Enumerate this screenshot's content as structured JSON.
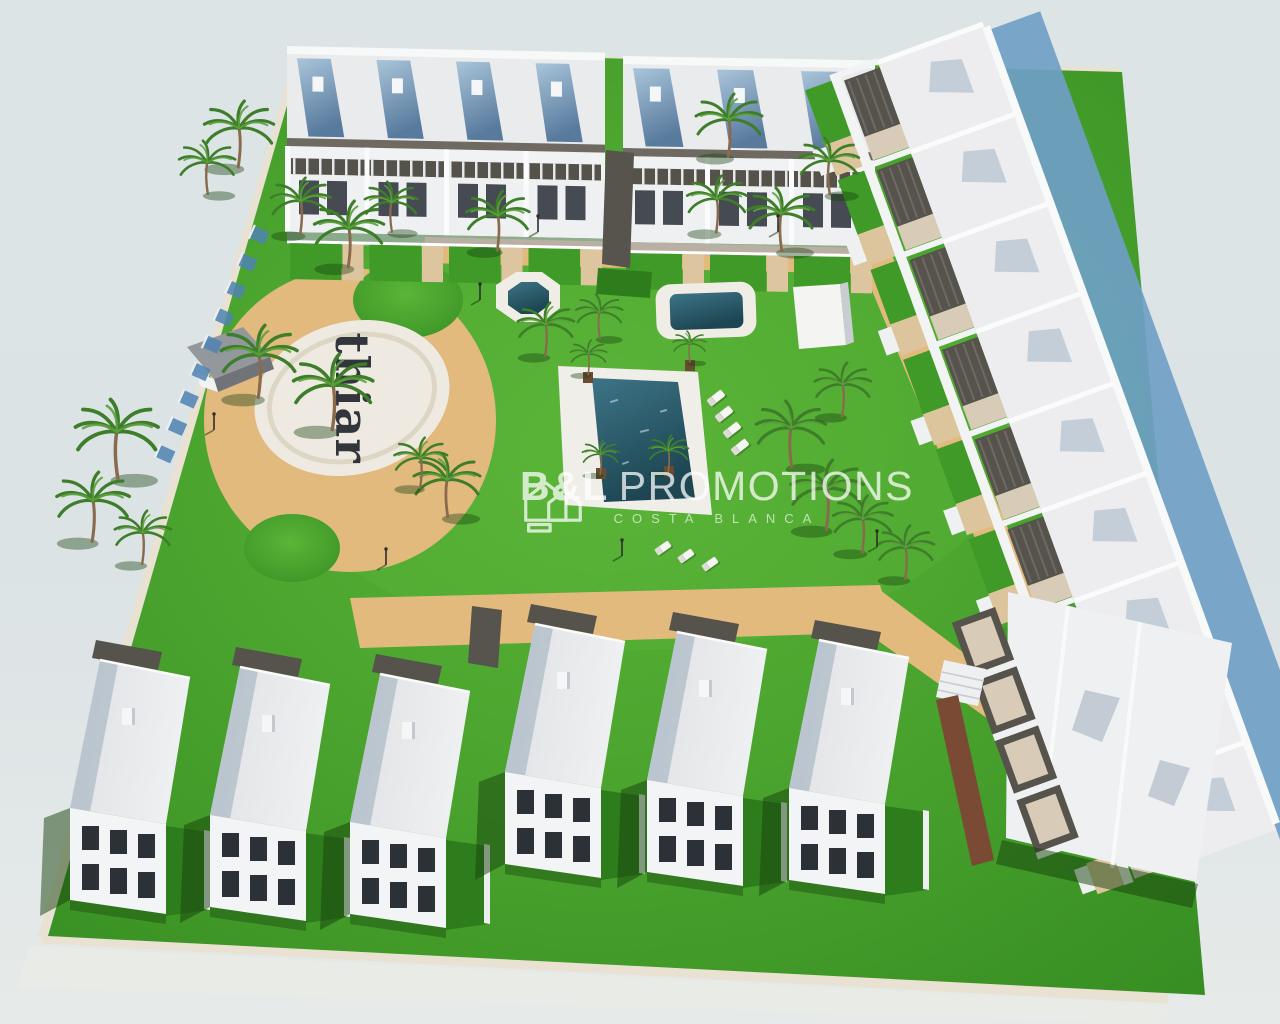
{
  "watermark": {
    "brand_bold": "B&L",
    "brand_regular": "PROMOTIONS",
    "subtitle": "COSTA BLANCA",
    "logo": "double-house-outline-icon",
    "text_color": "#ffffff"
  },
  "plaza": {
    "label": "thiar",
    "text_color": "#23262f",
    "surface_color": "#eeeae1"
  },
  "counts": {
    "top_apartment_blocks": 2,
    "right_row_townhouses": 9,
    "bottom_townhouses": 6,
    "ornamental_pools": 2,
    "main_pool": 1,
    "poolside_loungers": 4,
    "lawn_loungers": 3
  },
  "palette": {
    "sky": "#dce3e5",
    "grass": "#47a02c",
    "grass-dark": "#2e7d1d",
    "sand": "#e3ba7e",
    "water": "#26606e",
    "white-bld": "#f2f4f6",
    "roof": "#e7e9eb",
    "pergola": "#56524c",
    "shadow-blue": "#6f9fc6",
    "panel-blue": "#7fa3c4",
    "wall-beige": "#e9e2d2",
    "wood": "#7b4a34"
  }
}
